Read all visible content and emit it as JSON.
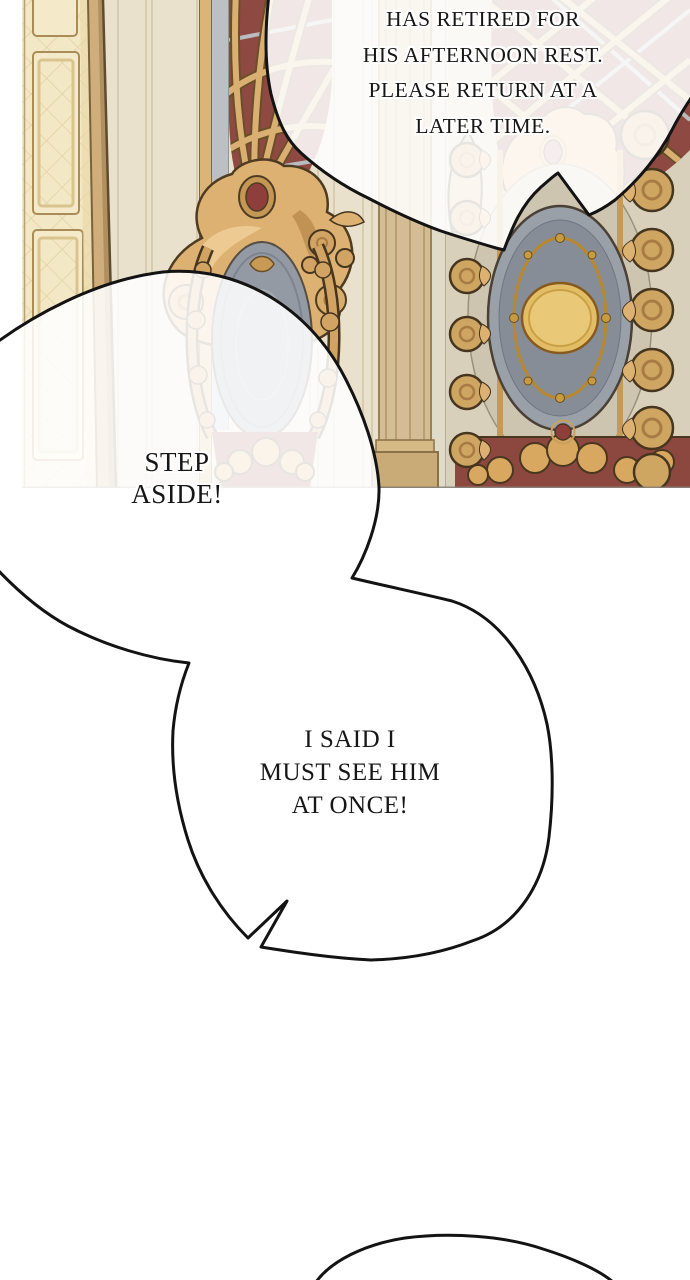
{
  "bubbles": {
    "top": {
      "text": "HAS RETIRED FOR\nHIS AFTERNOON REST.\nPLEASE RETURN AT A\nLATER TIME."
    },
    "step_aside": {
      "text": "STEP\nASIDE!"
    },
    "insist": {
      "text": "I SAID I\nMUST SEE HIM\nAT ONCE!"
    }
  },
  "colors": {
    "page_background": "#ffffff",
    "bubble_fill": "#ffffff",
    "bubble_outline": "#131313",
    "lettering": "#161616",
    "wall_beige": "#e9e1cc",
    "door_cream": "#f3e8c6",
    "gold_light": "#ecca92",
    "gold": "#d9ae6c",
    "gold_dark": "#4f3b22",
    "maroon_red": "#8e4a42",
    "gray_blue": "#959ba4",
    "medallion_disc_gold": "#e2bd66"
  }
}
